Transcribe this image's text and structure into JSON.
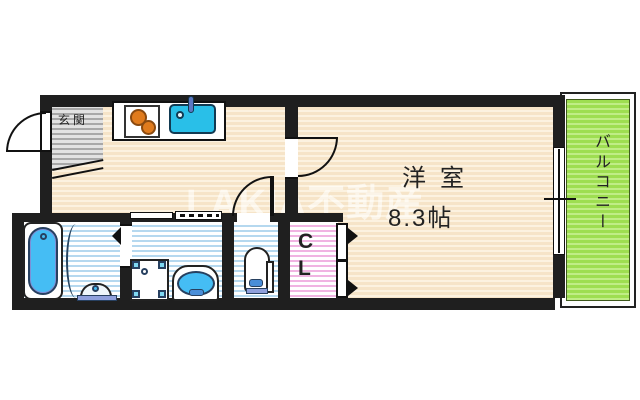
{
  "watermark": {
    "text": "LAKIA不動産"
  },
  "rooms": {
    "entrance": {
      "label": "玄関"
    },
    "main_room": {
      "label": "洋室",
      "size": "8.3帖"
    },
    "closet": {
      "line1": "C",
      "line2": "L"
    },
    "balcony": {
      "label": "バルコニー"
    },
    "kitchen": {
      "fixtures": [
        "two-burner-stove",
        "sink",
        "faucet"
      ]
    },
    "bathroom": {
      "fixtures": [
        "bathtub",
        "bath-counter"
      ]
    },
    "washroom": {
      "fixtures": [
        "washing-machine-pan",
        "washbasin"
      ]
    },
    "toilet_room": {
      "fixtures": [
        "toilet"
      ]
    }
  },
  "colors": {
    "wall": "#1f1f1f",
    "floor_wood": "#f6e4c8",
    "entrance_gray": "#c9c9c9",
    "wet_area_blue": "#b5d8ef",
    "closet_pink": "#f0b4e2",
    "balcony_green": "#9ede51",
    "sink_cyan": "#29bfe8",
    "tub_blue": "#45bdf4",
    "stove_orange": "#e07b1d",
    "plumbing_navy": "#274060"
  }
}
